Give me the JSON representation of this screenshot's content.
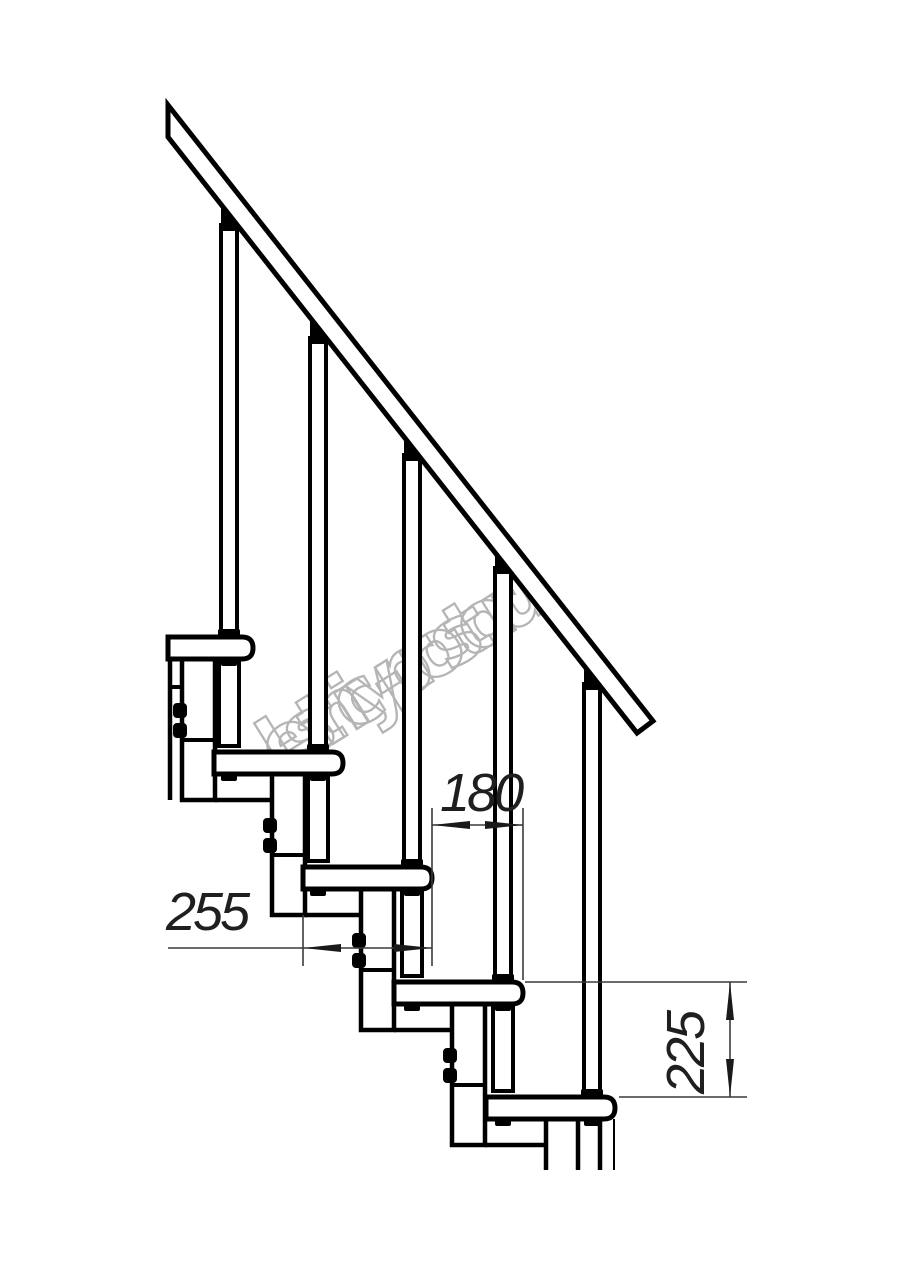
{
  "drawing": {
    "type": "staircase-side-view-technical-drawing",
    "background": "#ffffff",
    "line_color": "#000000",
    "dimension_color": "#3a3a3a"
  },
  "watermark": {
    "text": "lestnicy-prosto.ru",
    "color": "#b5b5b5"
  },
  "dimensions": {
    "tread_depth": "255",
    "step_run": "180",
    "step_rise": "225"
  }
}
